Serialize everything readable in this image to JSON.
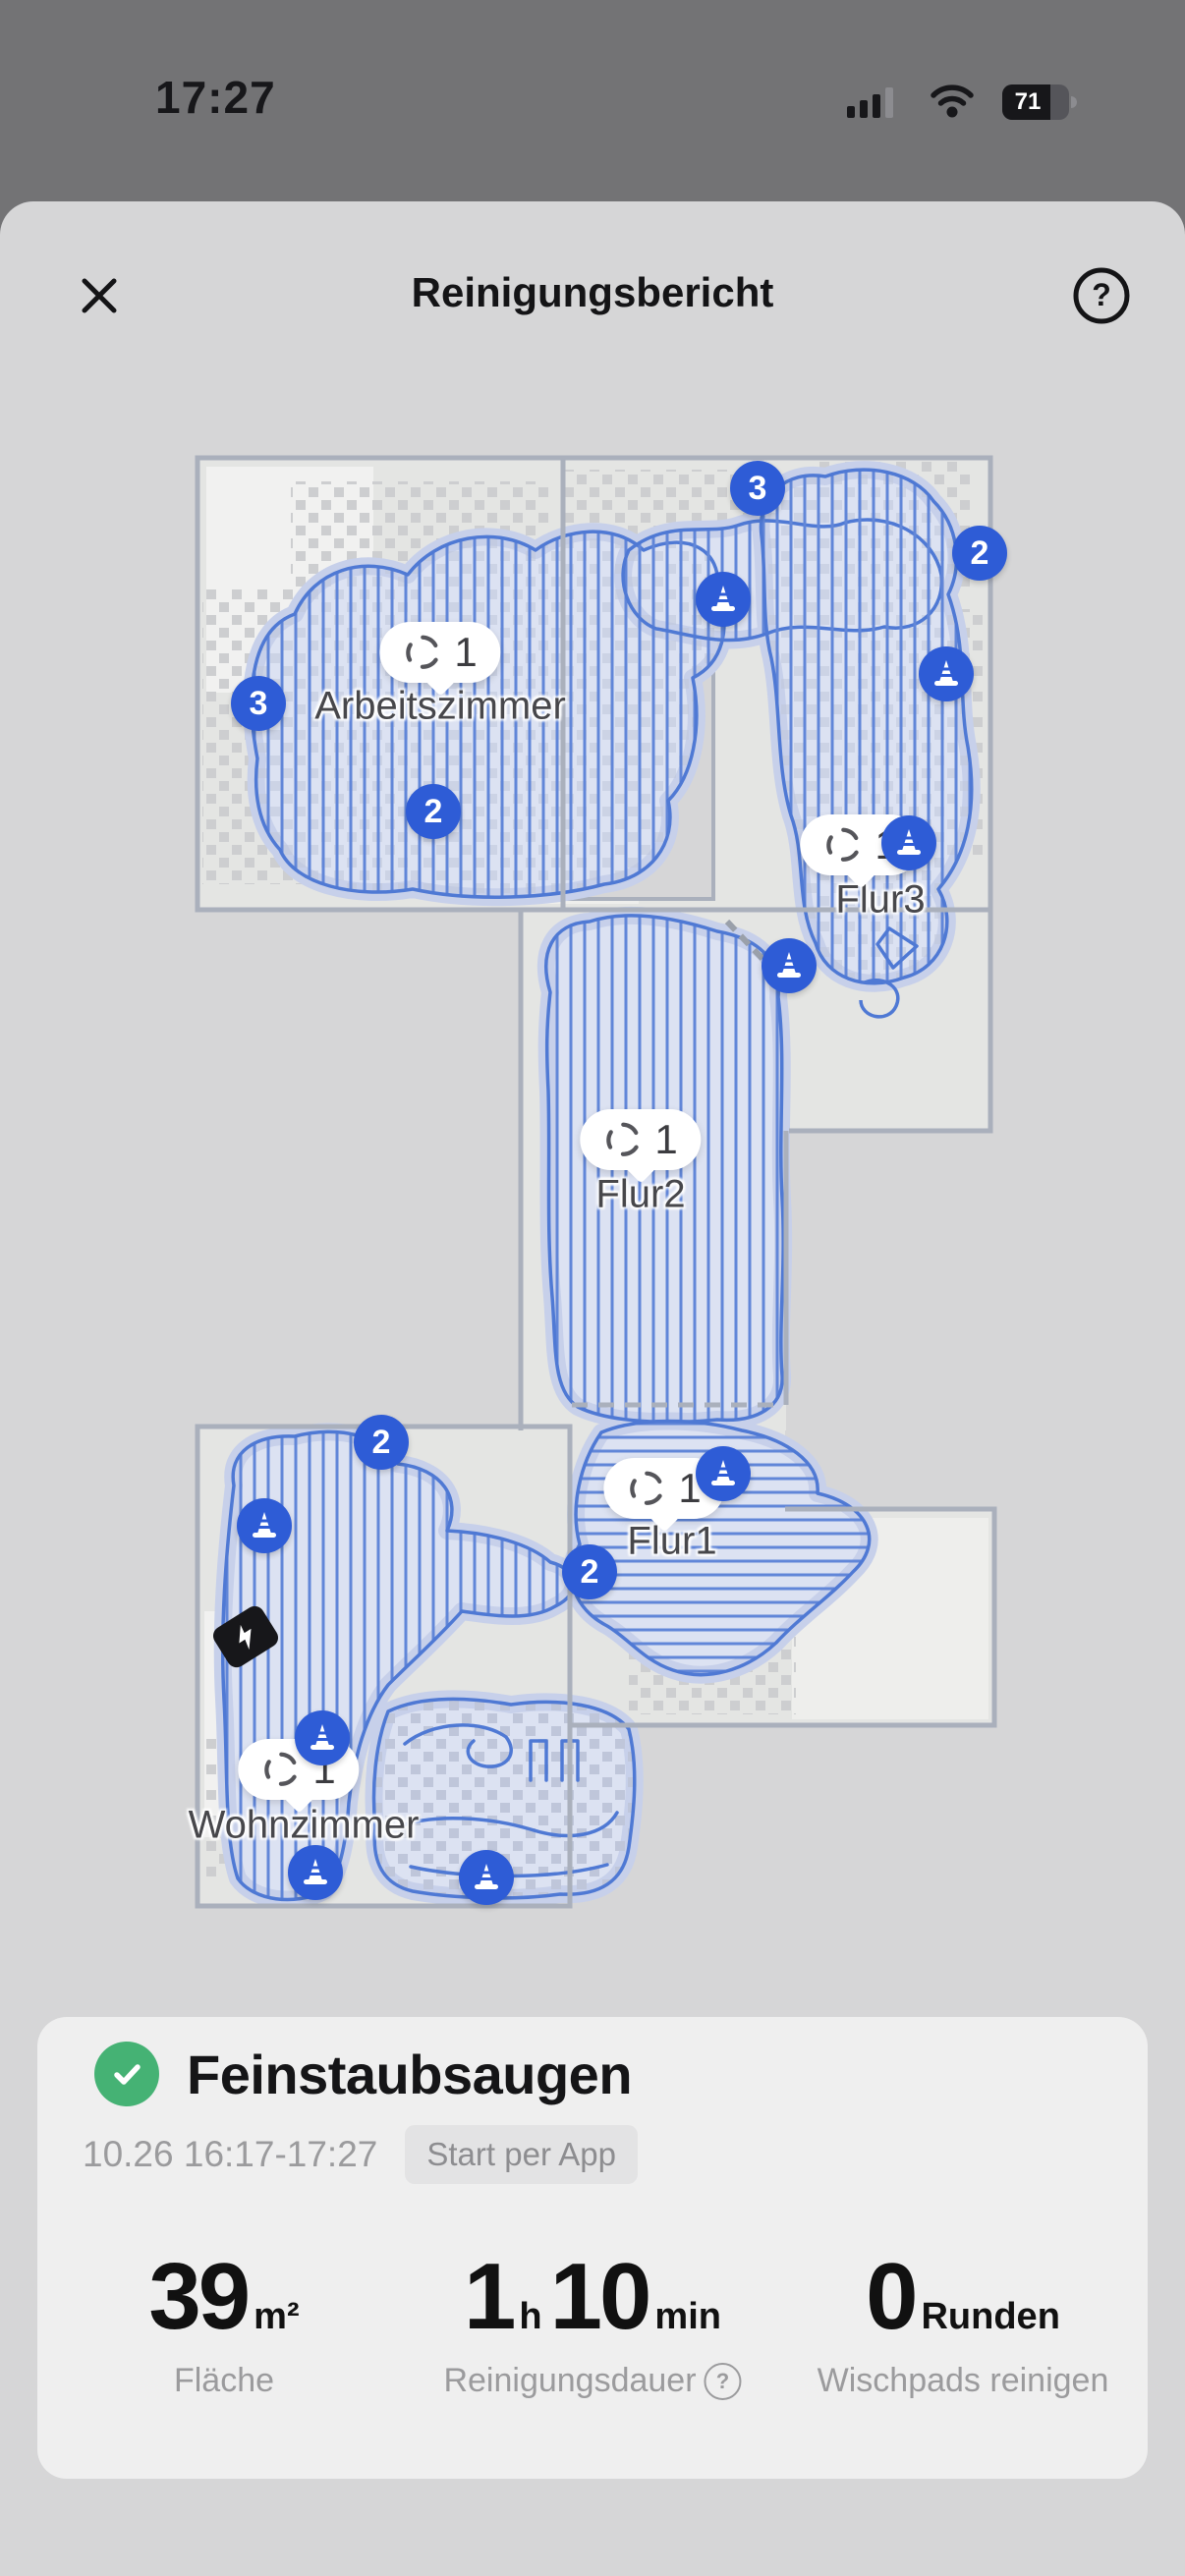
{
  "status_bar": {
    "time": "17:27",
    "battery_percent": "71"
  },
  "header": {
    "title": "Reinigungsbericht"
  },
  "map": {
    "rooms": [
      {
        "name": "Arbeitszimmer",
        "clean_count": "1"
      },
      {
        "name": "Flur3",
        "clean_count": "1"
      },
      {
        "name": "Flur2",
        "clean_count": "1"
      },
      {
        "name": "Flur1",
        "clean_count": "1"
      },
      {
        "name": "Wohnzimmer",
        "clean_count": "1"
      }
    ],
    "badges": [
      {
        "n": "3"
      },
      {
        "n": "2"
      },
      {
        "n": "3"
      },
      {
        "n": "2"
      },
      {
        "n": "2"
      },
      {
        "n": "2"
      }
    ]
  },
  "summary": {
    "title": "Feinstaubsaugen",
    "datetime": "10.26 16:17-17:27",
    "trigger_badge": "Start per App",
    "stats": [
      {
        "value": "39",
        "unit": "m²",
        "label": "Fläche"
      },
      {
        "value": "1",
        "unit": "h",
        "value2": "10",
        "unit2": "min",
        "label": "Reinigungsdauer"
      },
      {
        "value": "0",
        "unit": "Runden",
        "label": "Wischpads reinigen"
      }
    ]
  },
  "colors": {
    "accent_blue": "#2e5cd6",
    "path_blue": "#5b82d6",
    "clean_fill": "#dce2f2",
    "success_green": "#45b274",
    "sheet_gray": "#d6d6d7"
  }
}
